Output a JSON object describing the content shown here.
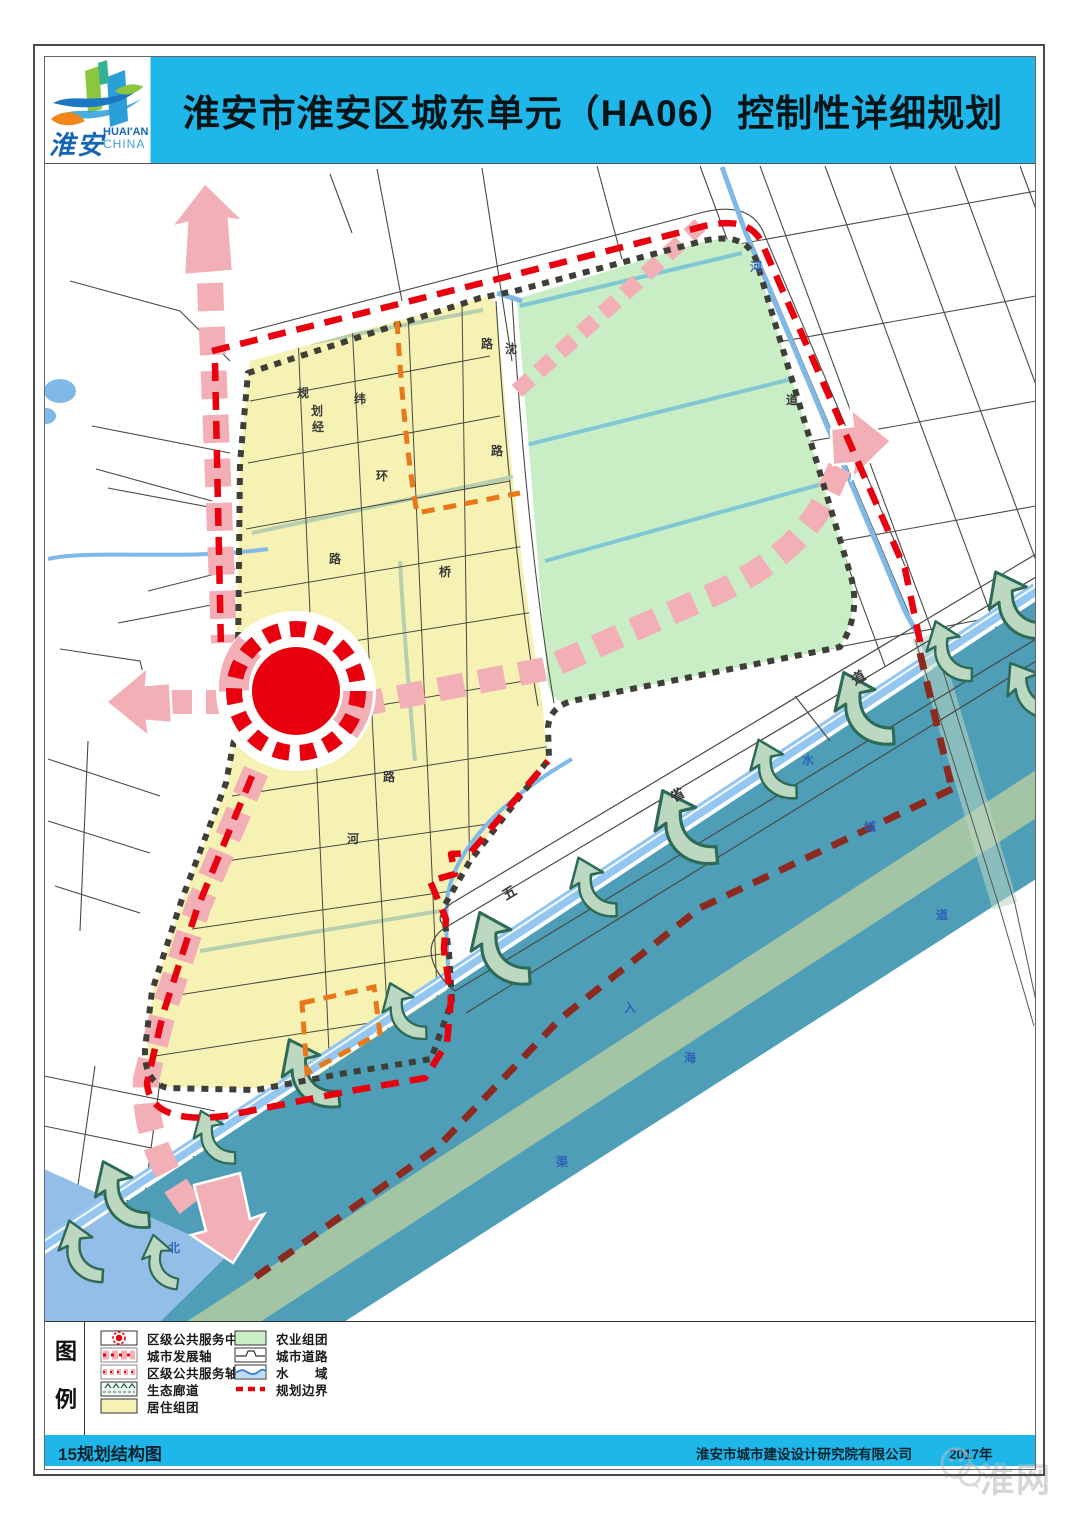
{
  "header": {
    "title": "淮安市淮安区城东单元（HA06）控制性详细规划",
    "logo": {
      "zh": "淮安",
      "en_top": "HUAI'AN",
      "en_bottom": "CHINA"
    }
  },
  "legend": {
    "title_vertical": [
      "图",
      "例"
    ],
    "items_left": [
      {
        "label": "区级公共服务中心",
        "swatch": "district-service-center-marker"
      },
      {
        "label": "城市发展轴",
        "swatch": "city-development-axis"
      },
      {
        "label": "区级公共服务轴",
        "swatch": "district-service-axis"
      },
      {
        "label": "生态廊道",
        "swatch": "ecological-corridor"
      },
      {
        "label": "居住组团",
        "swatch": "residential-cluster"
      }
    ],
    "items_right": [
      {
        "label": "农业组团",
        "swatch": "agricultural-cluster"
      },
      {
        "label": "城市道路",
        "swatch": "city-road"
      },
      {
        "label": "水　　域",
        "swatch": "water-area"
      },
      {
        "label": "规划边界",
        "swatch": "planning-boundary"
      }
    ]
  },
  "footer": {
    "left": "15规划结构图",
    "company": "淮安市城市建设设计研究院有限公司",
    "year": "2017年"
  },
  "watermark": {
    "text": "淮网"
  },
  "map": {
    "road_labels": [
      {
        "t": "沈"
      },
      {
        "t": "规"
      },
      {
        "t": "划"
      },
      {
        "t": "路"
      },
      {
        "t": "纬"
      },
      {
        "t": "经"
      },
      {
        "t": "环"
      },
      {
        "t": "路"
      },
      {
        "t": "桥"
      },
      {
        "t": "路"
      },
      {
        "t": "路"
      },
      {
        "t": "河"
      },
      {
        "t": "五"
      },
      {
        "t": "省"
      },
      {
        "t": "道"
      },
      {
        "t": "道"
      }
    ],
    "water_labels": [
      {
        "t": "河"
      },
      {
        "t": "水"
      },
      {
        "t": "域"
      },
      {
        "t": "入"
      },
      {
        "t": "海"
      },
      {
        "t": "道"
      },
      {
        "t": "北"
      },
      {
        "t": "渠"
      }
    ]
  },
  "colors": {
    "header_cyan": "#1fb6ea",
    "residential_yellow": "#f5f2b4",
    "agriculture_green": "#c9eec6",
    "water_band_teal": "#4e9eb8",
    "river_blue": "#7fb9e8",
    "axis_pink": "#f3afb6",
    "service_red": "#e8000f",
    "boundary_maroon": "#8c2a20",
    "orange_dash": "#e87818",
    "unit_boundary_gray": "#3f3f38",
    "sage_band": "#abc8a4"
  }
}
